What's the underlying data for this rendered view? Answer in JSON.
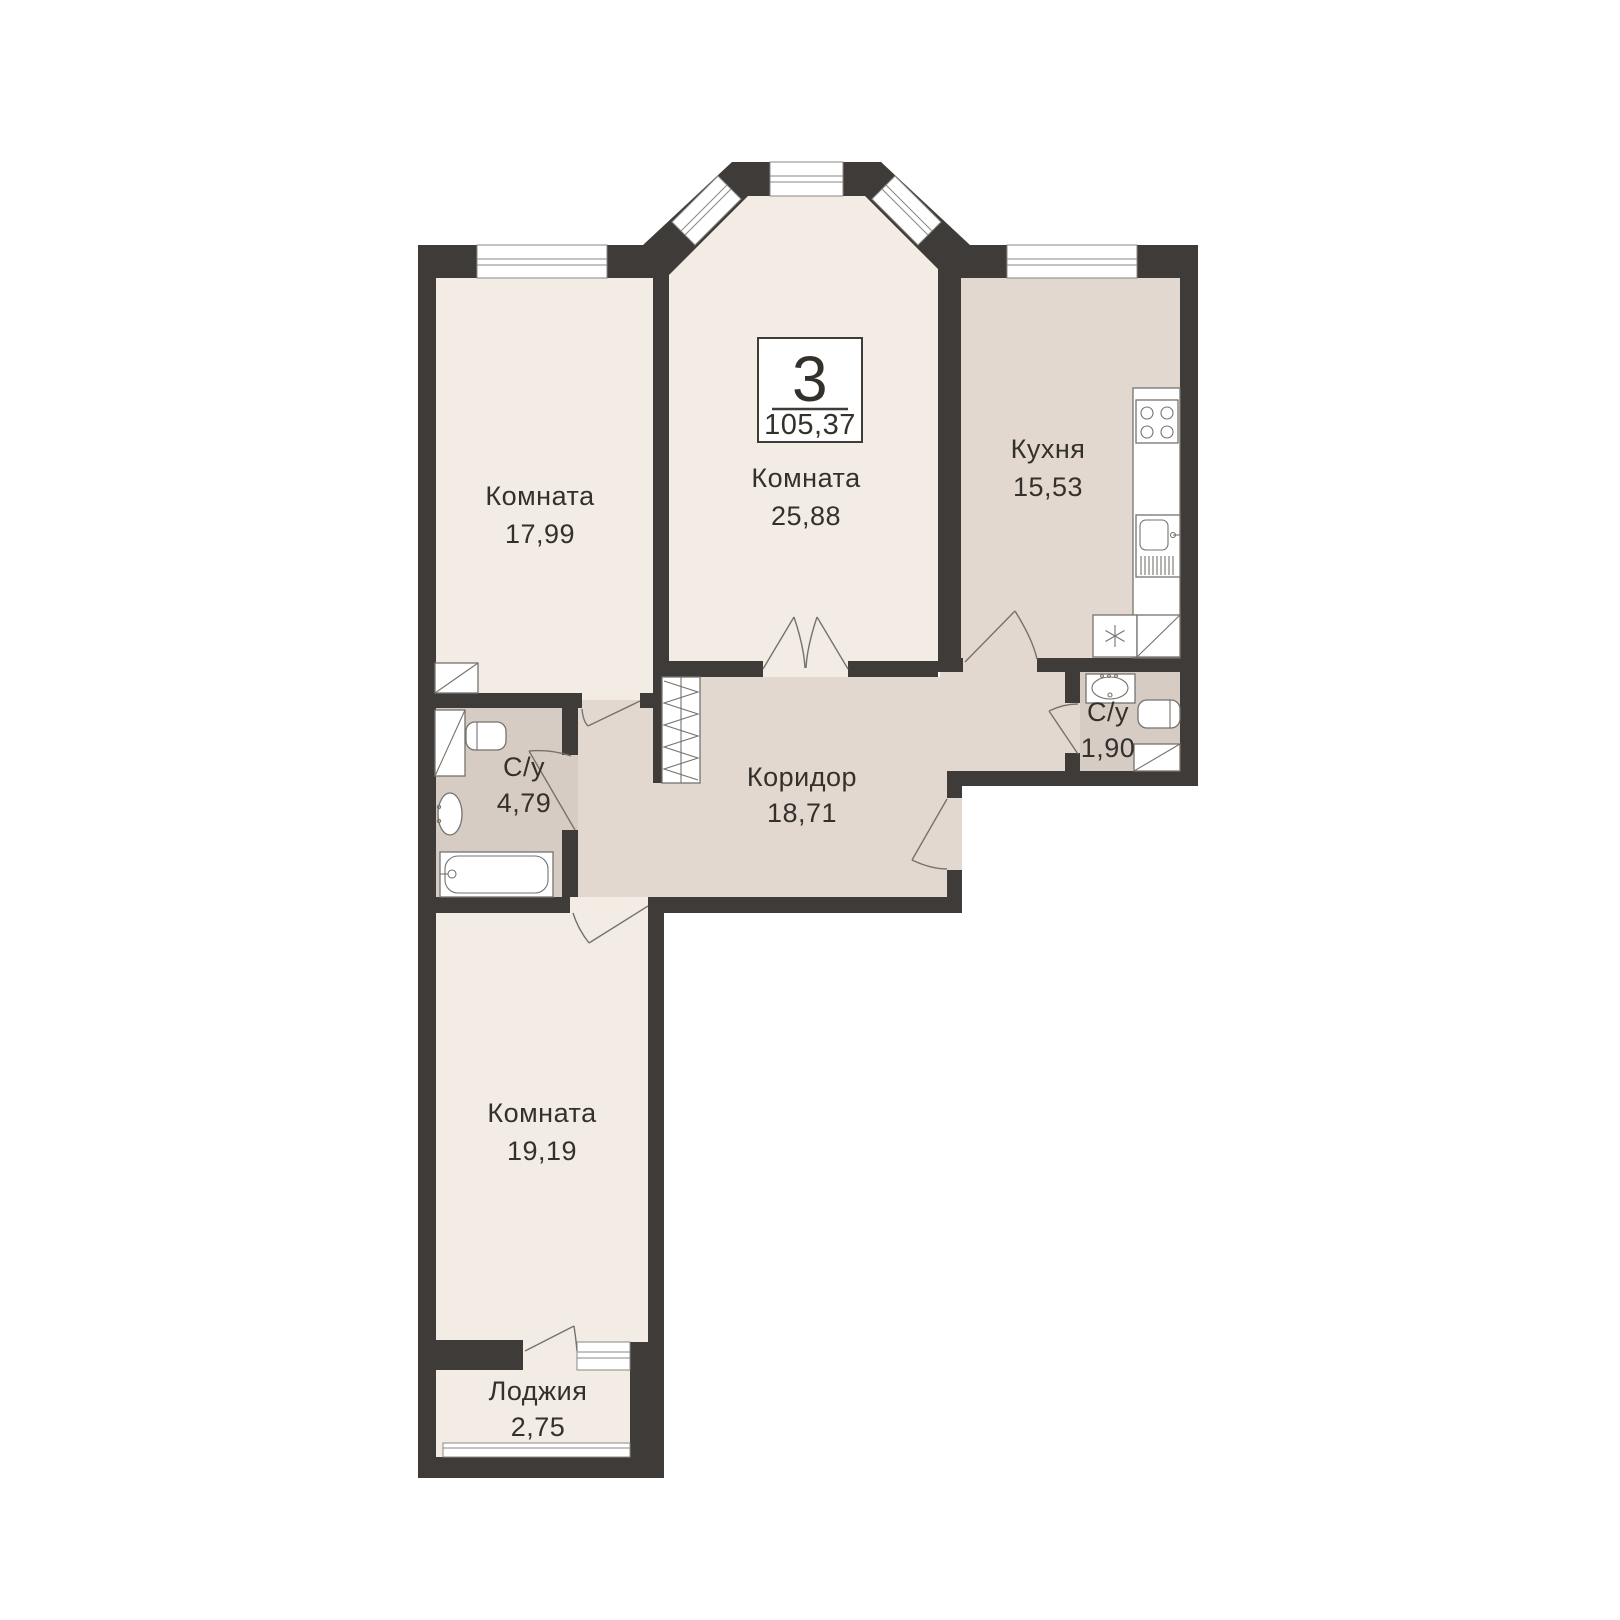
{
  "badge": {
    "rooms_count": "3",
    "total_area": "105,37"
  },
  "rooms": {
    "room1": {
      "name": "Комната",
      "area": "17,99"
    },
    "room2": {
      "name": "Комната",
      "area": "25,88"
    },
    "kitchen": {
      "name": "Кухня",
      "area": "15,53"
    },
    "bath1": {
      "name": "С/у",
      "area": "4,79"
    },
    "bath2": {
      "name": "С/у",
      "area": "1,90"
    },
    "corridor": {
      "name": "Коридор",
      "area": "18,71"
    },
    "room3": {
      "name": "Комната",
      "area": "19,19"
    },
    "loggia": {
      "name": "Лоджия",
      "area": "2,75"
    }
  },
  "colors": {
    "wall": "#3e3b38",
    "room_floor": "#f2ece4",
    "service_floor": "#e3d8d0",
    "wet_floor": "#d6ccc4",
    "fixture_line": "#75726e",
    "text": "#34312d",
    "background": "#ffffff"
  }
}
